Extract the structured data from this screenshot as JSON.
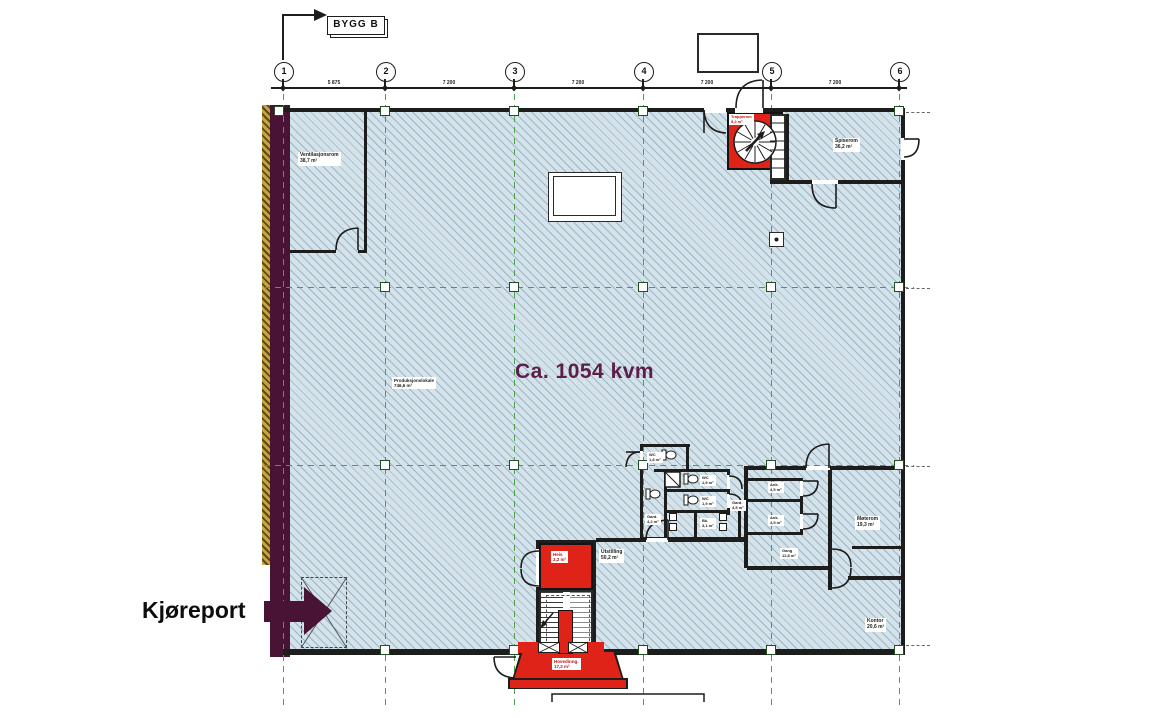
{
  "annotation": {
    "building_label": "BYGG B"
  },
  "grid": {
    "columns": [
      "1",
      "2",
      "3",
      "4",
      "5",
      "6"
    ],
    "dimensions": [
      "5 875",
      "7 200",
      "7 200",
      "7 200",
      "7 200"
    ]
  },
  "labels": {
    "area_total": "Ca. 1054 kvm",
    "kjoreport": "Kjøreport"
  },
  "rooms": {
    "ventilasjonsrom": "Ventilasjonsrom\n38,7 m²",
    "produksjonslokale": "Produksjonslokale\n746,6 m²",
    "trapperom": "Trapperom\n5,2 m²",
    "spiserom": "Spiserom\n36,2 m²",
    "wc_top": "WC\n1,8 m²",
    "wc_mid": "WC\n1,9 m²",
    "wc_low": "WC\n1,9 m²",
    "gard_left": "Gard.\n4,2 m²",
    "gard_right": "Gard.\n4,5 m²",
    "bk": "Bk.\n3,1 m²",
    "ank_top": "Ank.\n4,5 m²",
    "ank_low": "Ank.\n4,5 m²",
    "gang": "Gang\n12,8 m²",
    "moterom": "Møterom\n19,3 m²",
    "kontor": "Kontor\n20,6 m²",
    "heis": "Heis\n3,2 m²",
    "utstilling": "Utstilling\n50,2 m²",
    "hovedinngang": "Hovedinng.\n17,2 m²"
  },
  "colors": {
    "floor": "#d4e2ea",
    "hatch": "#8fb0c4",
    "wall": "#1d1d1b",
    "grid_green": "#4aa04a",
    "highlight_red": "#df2318",
    "highlight_maroon": "#481335",
    "area_text": "#5d1e4a",
    "yellow_strip": "#c8a43e"
  }
}
